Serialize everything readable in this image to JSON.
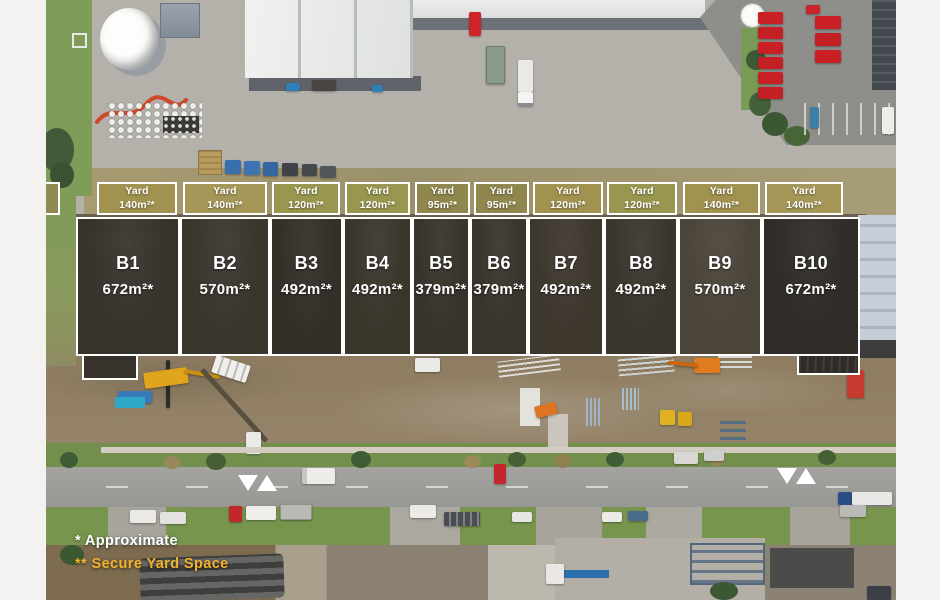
{
  "overlay": {
    "yards": [
      {
        "label": "Yard",
        "area": "140m²*"
      },
      {
        "label": "Yard",
        "area": "140m²*"
      },
      {
        "label": "Yard",
        "area": "120m²*"
      },
      {
        "label": "Yard",
        "area": "120m²*"
      },
      {
        "label": "Yard",
        "area": "95m²*"
      },
      {
        "label": "Yard",
        "area": "95m²*"
      },
      {
        "label": "Yard",
        "area": "120m²*"
      },
      {
        "label": "Yard",
        "area": "120m²*"
      },
      {
        "label": "Yard",
        "area": "140m²*"
      },
      {
        "label": "Yard",
        "area": "140m²*"
      }
    ],
    "units": [
      {
        "id": "B1",
        "area": "672m²*"
      },
      {
        "id": "B2",
        "area": "570m²*"
      },
      {
        "id": "B3",
        "area": "492m²*"
      },
      {
        "id": "B4",
        "area": "492m²*"
      },
      {
        "id": "B5",
        "area": "379m²*"
      },
      {
        "id": "B6",
        "area": "379m²*"
      },
      {
        "id": "B7",
        "area": "492m²*"
      },
      {
        "id": "B8",
        "area": "492m²*"
      },
      {
        "id": "B9",
        "area": "570m²*"
      },
      {
        "id": "B10",
        "area": "672m²*"
      }
    ],
    "footnotes": {
      "approximate": "* Approximate",
      "secure": "** Secure Yard Space"
    },
    "colors": {
      "overlay_white": "#ffffff",
      "footnote_yellow": "#f2b42d",
      "yard_fill_olive": "#a19250"
    }
  }
}
